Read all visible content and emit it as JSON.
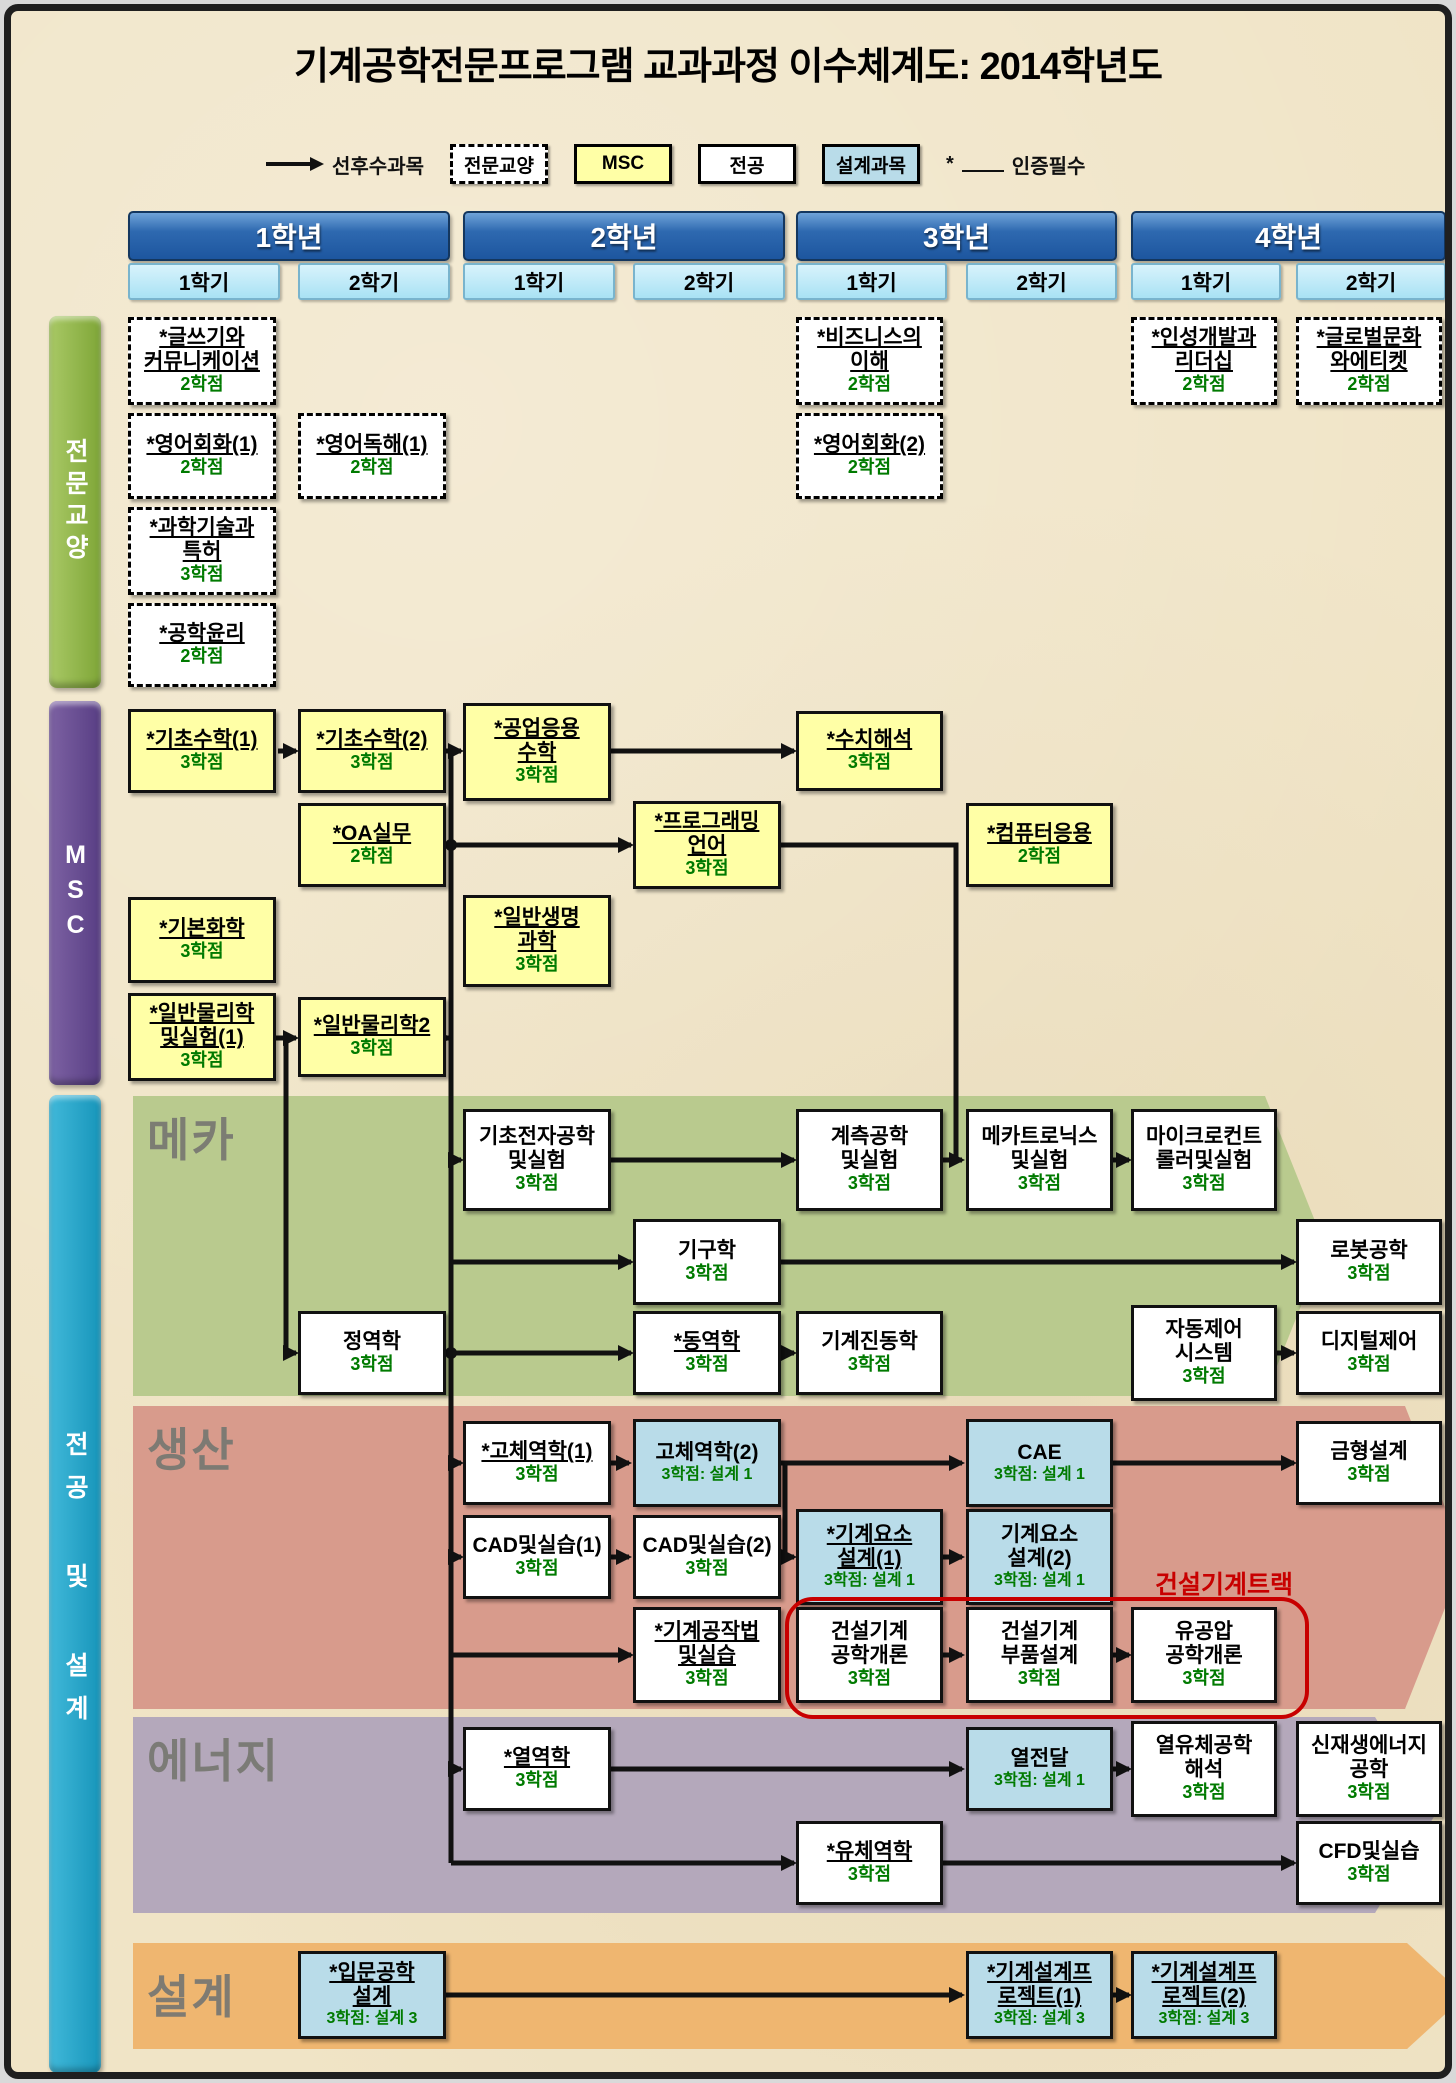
{
  "title": "기계공학전문프로그램 교과과정 이수체계도: 2014학년도",
  "legend": {
    "arrow_label": "선후수과목",
    "types": [
      {
        "label": "전문교양",
        "style": "dashed"
      },
      {
        "label": "MSC",
        "style": "msc"
      },
      {
        "label": "전공",
        "style": "major"
      },
      {
        "label": "설계과목",
        "style": "design"
      }
    ],
    "required_star": "*",
    "required_label": "인증필수"
  },
  "years": [
    {
      "label": "1학년",
      "semesters": [
        "1학기",
        "2학기"
      ]
    },
    {
      "label": "2학년",
      "semesters": [
        "1학기",
        "2학기"
      ]
    },
    {
      "label": "3학년",
      "semesters": [
        "1학기",
        "2학기"
      ]
    },
    {
      "label": "4학년",
      "semesters": [
        "1학기",
        "2학기"
      ]
    }
  ],
  "sidebars": [
    {
      "id": "liberal",
      "label": "전문교양"
    },
    {
      "id": "msc",
      "label": "MSC"
    },
    {
      "id": "major",
      "label": "전공 및 설계"
    }
  ],
  "tracks": [
    {
      "id": "mecha",
      "label": "메카"
    },
    {
      "id": "production",
      "label": "생산"
    },
    {
      "id": "energy",
      "label": "에너지"
    },
    {
      "id": "design",
      "label": "설계"
    }
  ],
  "construction_track_note": "건설기계트랙",
  "colors": {
    "background": "#f0e4c6",
    "year_bar": "#2e69b0",
    "semester": "#a9e2f4",
    "liberal_sidebar": "#8cb04a",
    "msc_sidebar": "#6b4f92",
    "major_sidebar": "#2aa8c8",
    "mecha_band": "#b9ca8e",
    "production_band": "#d89b8c",
    "energy_band": "#b4a8bb",
    "design_band": "#efb670",
    "msc_box": "#ffffa6",
    "design_box": "#b9dce9",
    "credit_green": "#007a00",
    "construction_red": "#c80000"
  },
  "courses": [
    {
      "kind": "dashed",
      "col": 0,
      "y": 306,
      "h": 88,
      "title": "*글쓰기와\n커뮤니케이션",
      "credit": "2학점"
    },
    {
      "kind": "dashed",
      "col": 0,
      "y": 402,
      "h": 86,
      "title": "*영어회화(1)",
      "credit": "2학점"
    },
    {
      "kind": "dashed",
      "col": 1,
      "y": 402,
      "h": 86,
      "title": "*영어독해(1)",
      "credit": "2학점"
    },
    {
      "kind": "dashed",
      "col": 0,
      "y": 496,
      "h": 88,
      "title": "*과학기술과\n특허",
      "credit": "3학점"
    },
    {
      "kind": "dashed",
      "col": 0,
      "y": 592,
      "h": 84,
      "title": "*공학윤리",
      "credit": "2학점"
    },
    {
      "kind": "dashed",
      "col": 4,
      "y": 306,
      "h": 88,
      "title": "*비즈니스의\n이해",
      "credit": "2학점"
    },
    {
      "kind": "dashed",
      "col": 4,
      "y": 402,
      "h": 86,
      "title": "*영어회화(2)",
      "credit": "2학점"
    },
    {
      "kind": "dashed",
      "col": 6,
      "y": 306,
      "h": 88,
      "title": "*인성개발과\n리더십",
      "credit": "2학점"
    },
    {
      "kind": "dashed",
      "col": 7,
      "y": 306,
      "h": 88,
      "title": "*글로벌문화\n와에티켓",
      "credit": "2학점"
    },
    {
      "kind": "msc",
      "col": 0,
      "y": 698,
      "h": 84,
      "title": "*기초수학(1)",
      "credit": "3학점"
    },
    {
      "kind": "msc",
      "col": 1,
      "y": 698,
      "h": 84,
      "title": "*기초수학(2)",
      "credit": "3학점"
    },
    {
      "kind": "msc",
      "col": 2,
      "y": 692,
      "h": 98,
      "title": "*공업응용\n수학",
      "credit": "3학점"
    },
    {
      "kind": "msc",
      "col": 4,
      "y": 700,
      "h": 80,
      "title": "*수치해석",
      "credit": "3학점"
    },
    {
      "kind": "msc",
      "col": 1,
      "y": 792,
      "h": 84,
      "title": "*OA실무",
      "credit": "2학점"
    },
    {
      "kind": "msc",
      "col": 3,
      "y": 790,
      "h": 88,
      "title": "*프로그래밍\n언어",
      "credit": "3학점"
    },
    {
      "kind": "msc",
      "col": 5,
      "y": 792,
      "h": 84,
      "title": "*컴퓨터응용",
      "credit": "2학점"
    },
    {
      "kind": "msc",
      "col": 0,
      "y": 886,
      "h": 86,
      "title": "*기본화학",
      "credit": "3학점"
    },
    {
      "kind": "msc",
      "col": 2,
      "y": 884,
      "h": 92,
      "title": "*일반생명\n과학",
      "credit": "3학점"
    },
    {
      "kind": "msc",
      "col": 0,
      "y": 982,
      "h": 88,
      "title": "*일반물리학\n및실험(1)",
      "credit": "3학점"
    },
    {
      "kind": "msc",
      "col": 1,
      "y": 986,
      "h": 80,
      "title": "*일반물리학2",
      "credit": "3학점"
    },
    {
      "kind": "major",
      "col": 2,
      "y": 1098,
      "h": 102,
      "title": "기초전자공학\n및실험",
      "credit": "3학점"
    },
    {
      "kind": "major",
      "col": 4,
      "y": 1098,
      "h": 102,
      "title": "계측공학\n및실험",
      "credit": "3학점"
    },
    {
      "kind": "major",
      "col": 5,
      "y": 1098,
      "h": 102,
      "title": "메카트로닉스\n및실험",
      "credit": "3학점"
    },
    {
      "kind": "major",
      "col": 6,
      "y": 1098,
      "h": 102,
      "title": "마이크로컨트\n롤러및실험",
      "credit": "3학점"
    },
    {
      "kind": "major",
      "col": 3,
      "y": 1208,
      "h": 86,
      "title": "기구학",
      "credit": "3학점"
    },
    {
      "kind": "major",
      "col": 7,
      "y": 1208,
      "h": 86,
      "title": "로봇공학",
      "credit": "3학점"
    },
    {
      "kind": "major",
      "col": 1,
      "y": 1300,
      "h": 84,
      "title": "정역학",
      "credit": "3학점"
    },
    {
      "kind": "major",
      "col": 3,
      "y": 1300,
      "h": 84,
      "title": "*동역학",
      "credit": "3학점"
    },
    {
      "kind": "major",
      "col": 4,
      "y": 1300,
      "h": 84,
      "title": "기계진동학",
      "credit": "3학점"
    },
    {
      "kind": "major",
      "col": 6,
      "y": 1294,
      "h": 96,
      "title": "자동제어\n시스템",
      "credit": "3학점"
    },
    {
      "kind": "major",
      "col": 7,
      "y": 1300,
      "h": 84,
      "title": "디지털제어",
      "credit": "3학점"
    },
    {
      "kind": "major",
      "col": 2,
      "y": 1410,
      "h": 84,
      "title": "*고체역학(1)",
      "credit": "3학점"
    },
    {
      "kind": "design",
      "col": 3,
      "y": 1408,
      "h": 88,
      "title": "고체역학(2)",
      "credit": "3학점: 설계 1"
    },
    {
      "kind": "design",
      "col": 5,
      "y": 1408,
      "h": 88,
      "title": "CAE",
      "credit": "3학점: 설계 1"
    },
    {
      "kind": "major",
      "col": 7,
      "y": 1410,
      "h": 84,
      "title": "금형설계",
      "credit": "3학점"
    },
    {
      "kind": "major",
      "col": 2,
      "y": 1504,
      "h": 84,
      "title": "CAD및실습(1)",
      "credit": "3학점"
    },
    {
      "kind": "major",
      "col": 3,
      "y": 1504,
      "h": 84,
      "title": "CAD및실습(2)",
      "credit": "3학점"
    },
    {
      "kind": "design",
      "col": 4,
      "y": 1498,
      "h": 96,
      "title": "*기계요소\n설계(1)",
      "credit": "3학점: 설계 1"
    },
    {
      "kind": "design",
      "col": 5,
      "y": 1498,
      "h": 96,
      "title": "기계요소\n설계(2)",
      "credit": "3학점: 설계 1"
    },
    {
      "kind": "major",
      "col": 3,
      "y": 1596,
      "h": 96,
      "title": "*기계공작법\n및실습",
      "credit": "3학점"
    },
    {
      "kind": "major",
      "col": 4,
      "y": 1596,
      "h": 96,
      "title": "건설기계\n공학개론",
      "credit": "3학점"
    },
    {
      "kind": "major",
      "col": 5,
      "y": 1596,
      "h": 96,
      "title": "건설기계\n부품설계",
      "credit": "3학점"
    },
    {
      "kind": "major",
      "col": 6,
      "y": 1596,
      "h": 96,
      "title": "유공압\n공학개론",
      "credit": "3학점"
    },
    {
      "kind": "major",
      "col": 2,
      "y": 1716,
      "h": 84,
      "title": "*열역학",
      "credit": "3학점"
    },
    {
      "kind": "design",
      "col": 5,
      "y": 1716,
      "h": 84,
      "title": "열전달",
      "credit": "3학점: 설계 1"
    },
    {
      "kind": "major",
      "col": 6,
      "y": 1710,
      "h": 96,
      "title": "열유체공학\n해석",
      "credit": "3학점"
    },
    {
      "kind": "major",
      "col": 7,
      "y": 1710,
      "h": 96,
      "title": "신재생에너지\n공학",
      "credit": "3학점"
    },
    {
      "kind": "major",
      "col": 4,
      "y": 1810,
      "h": 84,
      "title": "*유체역학",
      "credit": "3학점"
    },
    {
      "kind": "major",
      "col": 7,
      "y": 1810,
      "h": 84,
      "title": "CFD및실습",
      "credit": "3학점"
    },
    {
      "kind": "design",
      "col": 1,
      "y": 1940,
      "h": 88,
      "title": "*입문공학\n설계",
      "credit": "3학점: 설계 3"
    },
    {
      "kind": "design",
      "col": 5,
      "y": 1940,
      "h": 88,
      "title": "*기계설계프\n로젝트(1)",
      "credit": "3학점: 설계 3"
    },
    {
      "kind": "design",
      "col": 6,
      "y": 1940,
      "h": 88,
      "title": "*기계설계프\n로젝트(2)",
      "credit": "3학점: 설계 3"
    }
  ]
}
